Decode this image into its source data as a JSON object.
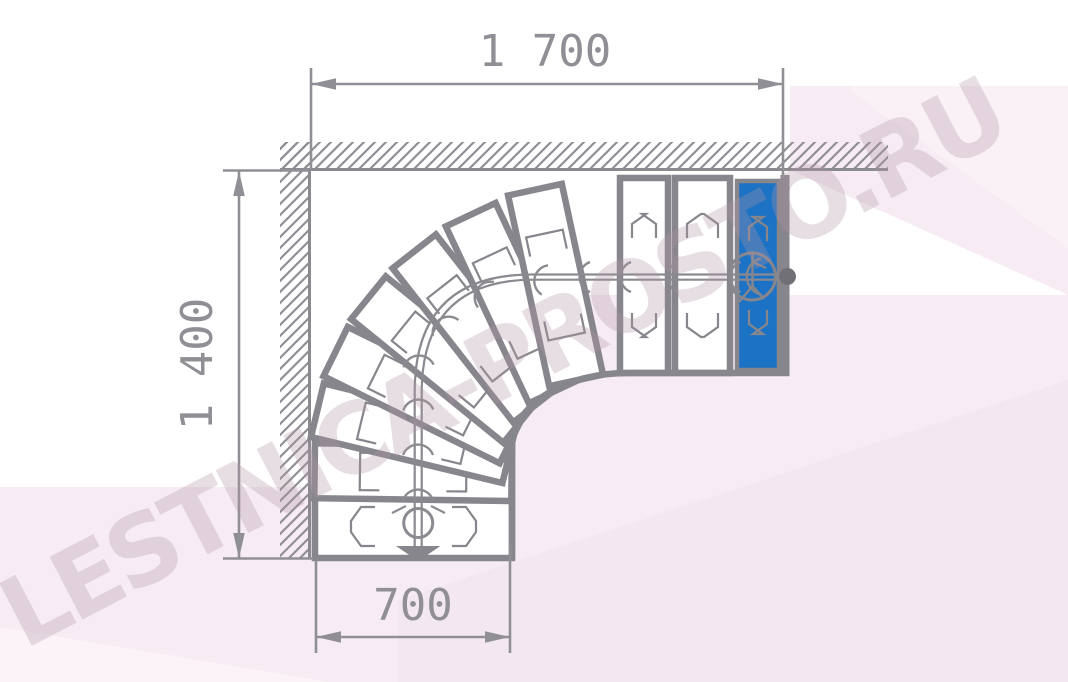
{
  "watermark": {
    "text": "LESTNICA-PROSTO.RU"
  },
  "dimensions": {
    "top": {
      "label": "1 700",
      "value_mm": 1700
    },
    "left": {
      "label": "1 400",
      "value_mm": 1400
    },
    "bottom": {
      "label": "700",
      "value_mm": 700
    }
  },
  "diagram_data": {
    "type": "staircase-plan",
    "description": "Plan view of a 90-degree quarter-turn winder staircase fitted into a corner of two hatched walls; descent from the blue top step (right, with start circle and end dot) around the winder fan to the bottom exit arrow.",
    "plan_width_mm": 1700,
    "plan_depth_mm": 1400,
    "flight_width_mm": 700,
    "tread_counts": {
      "bottom_straight": 2,
      "winders": 7,
      "right_straight": 2,
      "top_blue": 1
    },
    "walls": [
      "top",
      "left"
    ],
    "walk_line": {
      "start": "figure-in-circle on blue top step",
      "end": "down arrow at bottom flight exit"
    }
  },
  "colors": {
    "outline": "#87868c",
    "thin": "#8b8a90",
    "dimension": "#908f95",
    "hatch": "#908f95",
    "top_step_blue": "#1c72c4",
    "walk_dot": "#717077",
    "step_fill": "#ffffff",
    "pink_main": "#f7ecf3",
    "pink_light": "#fbf3f8",
    "pink_deep": "#f4e8f0"
  }
}
